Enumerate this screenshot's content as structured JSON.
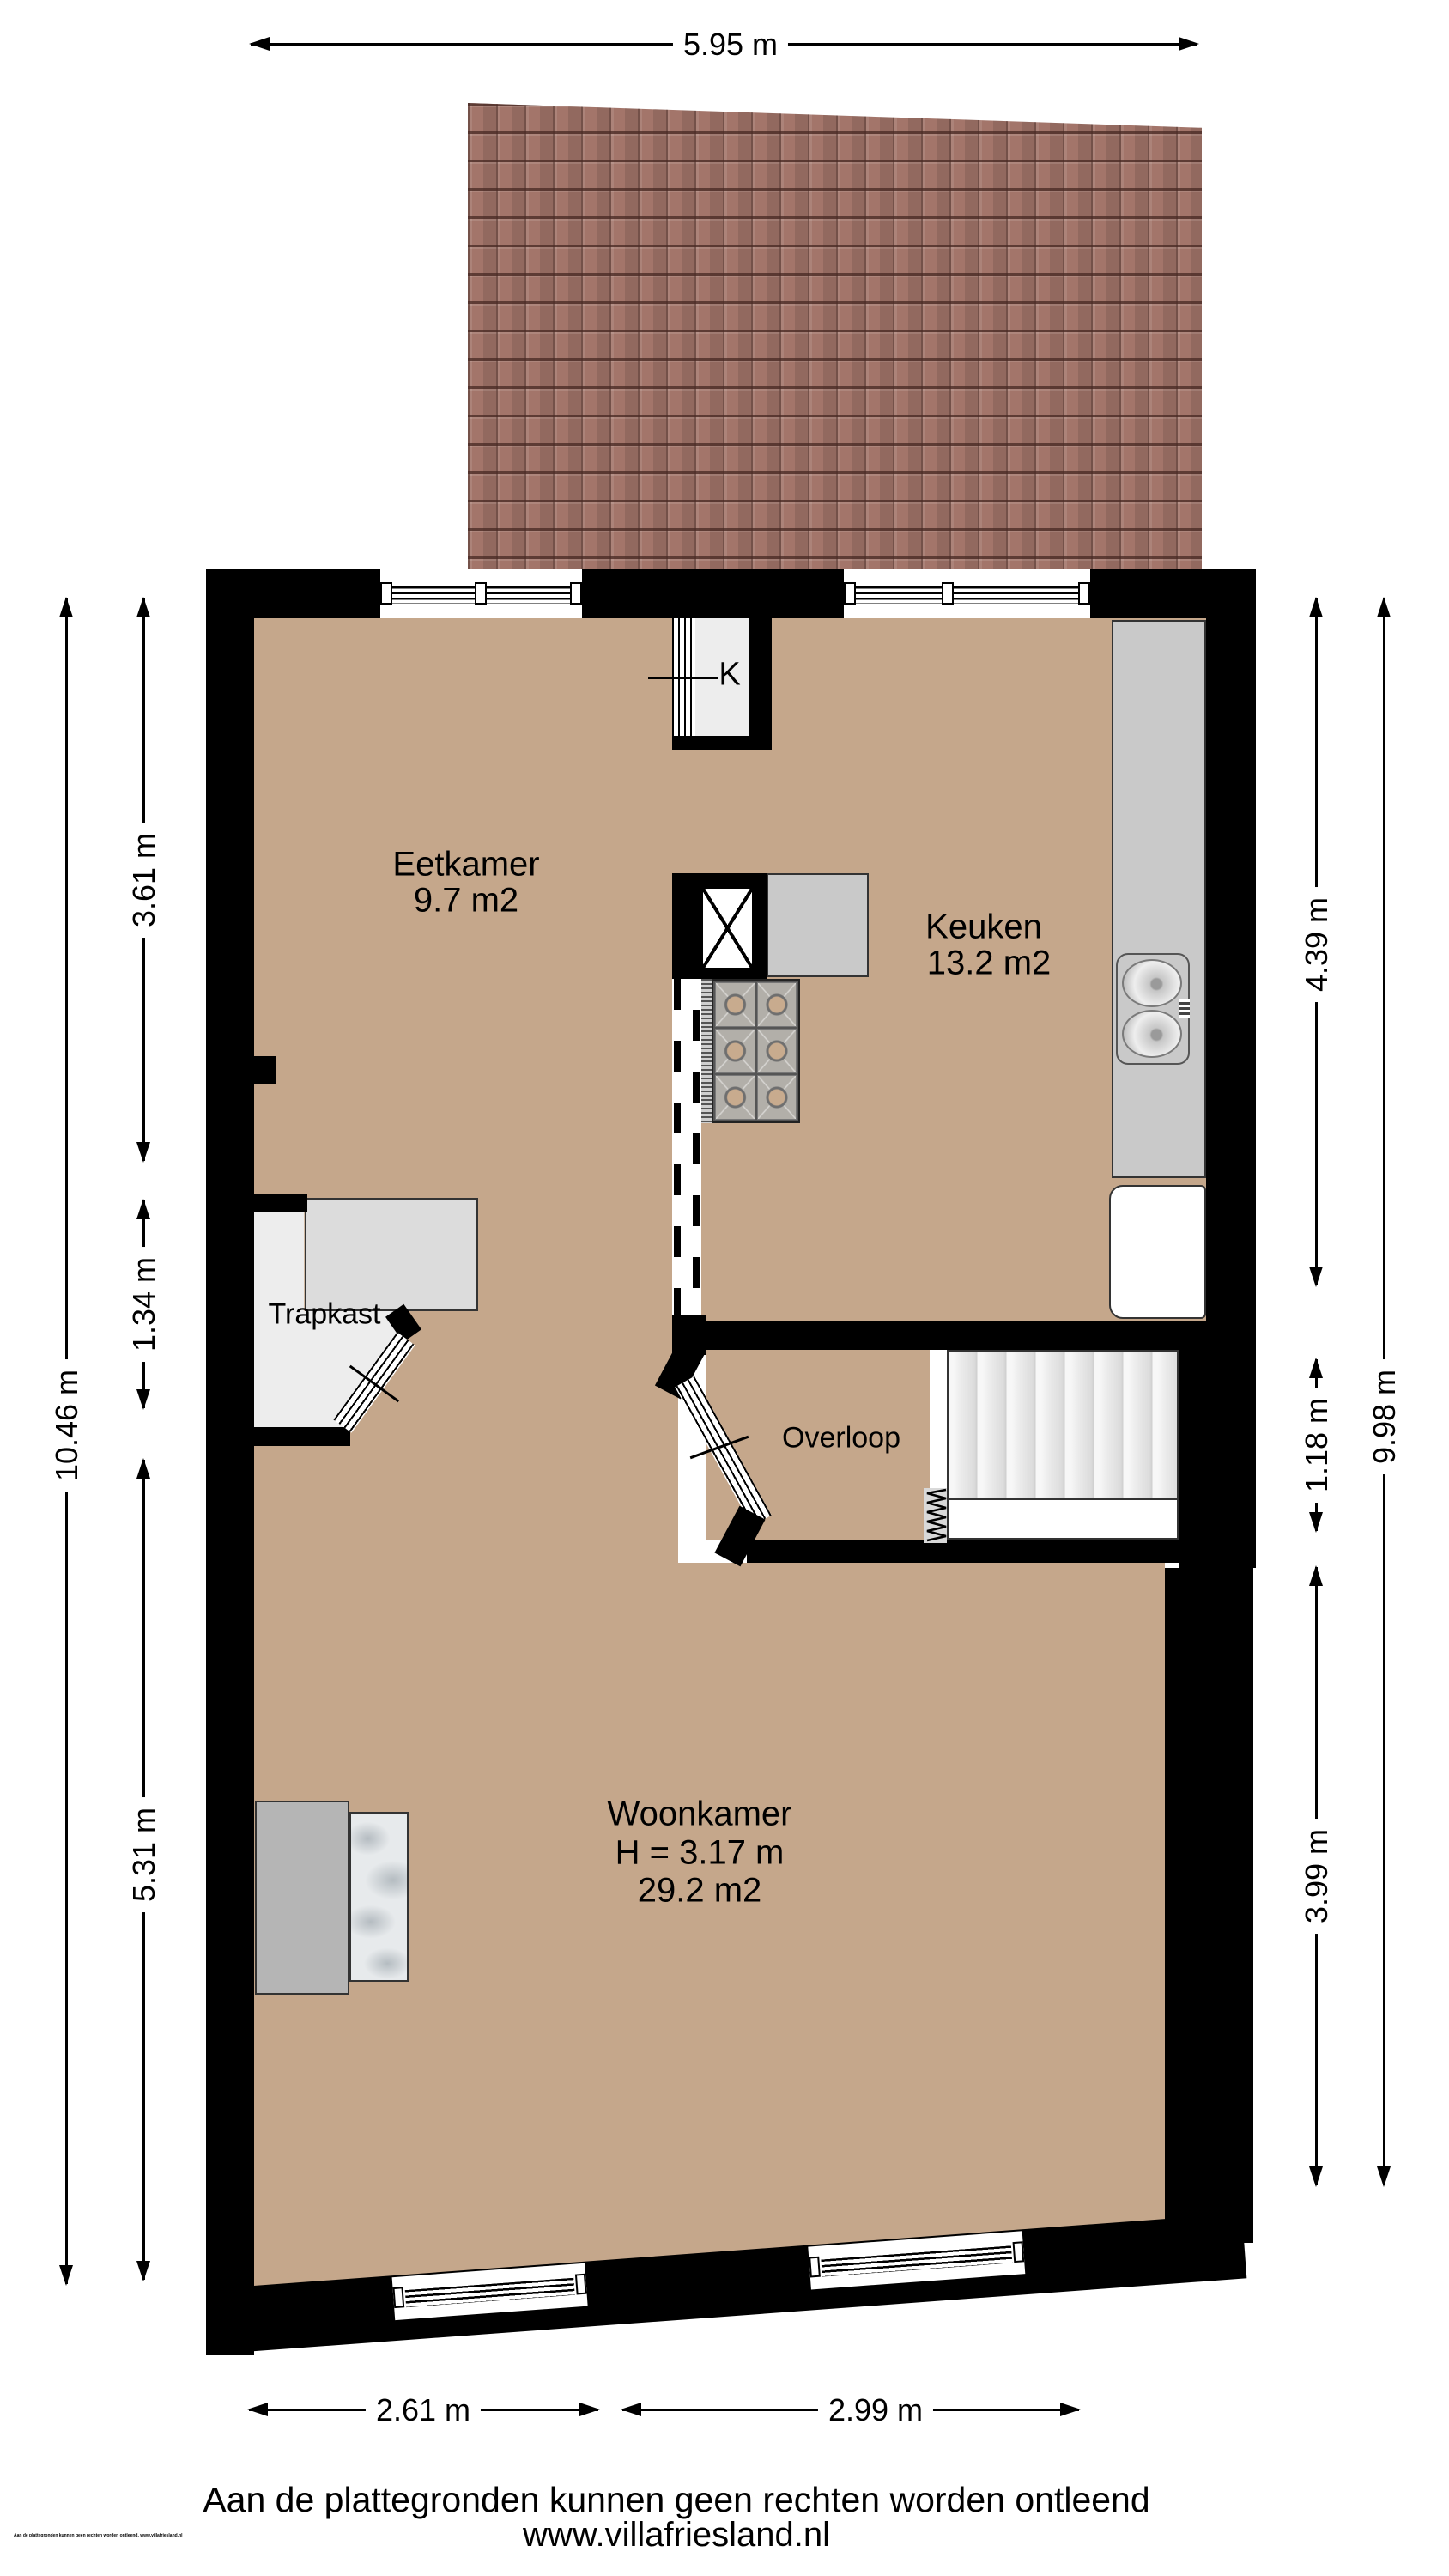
{
  "meta": {
    "floor_color": "#c5a78b",
    "roof_color": "#a3756a",
    "wall_color": "#000000",
    "counter_color": "#c9c9c9"
  },
  "rooms": {
    "eetkamer": {
      "name": "Eetkamer",
      "area": "9.7 m2"
    },
    "keuken": {
      "name": "Keuken",
      "area": "13.2 m2"
    },
    "trapkast": {
      "name": "Trapkast"
    },
    "overloop": {
      "name": "Overloop"
    },
    "woonkamer": {
      "name": "Woonkamer",
      "height": "H = 3.17 m",
      "area": "29.2 m2"
    },
    "kast": {
      "name": "K"
    }
  },
  "dimensions": {
    "top": "5.95 m",
    "left_outer": "10.46 m",
    "left_top": "3.61 m",
    "left_middle": "1.34 m",
    "left_bottom": "5.31 m",
    "right_top": "4.39 m",
    "right_middle": "1.18 m",
    "right_bottom": "3.99 m",
    "right_outer": "9.98 m",
    "bottom_left": "2.61 m",
    "bottom_right": "2.99 m"
  },
  "footer": {
    "disclaimer": "Aan de plattegronden kunnen geen rechten worden ontleend",
    "website": "www.villafriesland.nl",
    "small_print": "Aan de plattegronden kunnen geen rechten worden ontleend. www.villafriesland.nl"
  }
}
